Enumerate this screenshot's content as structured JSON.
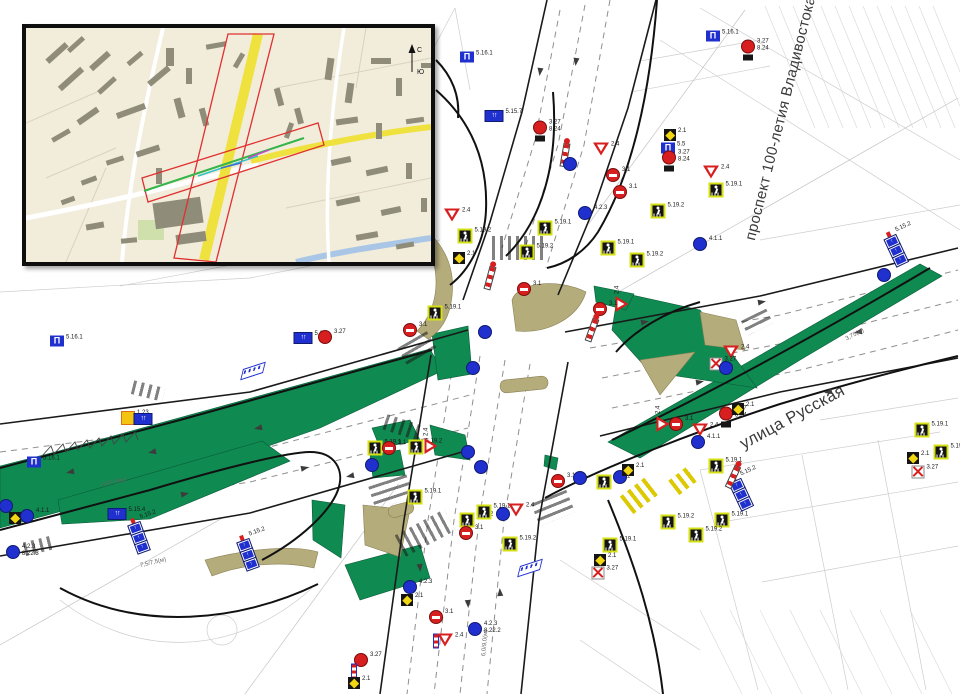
{
  "streets": {
    "prospekt": "проспект 100-летия Владивостока",
    "russkaya": "улица Русская"
  },
  "inset": {
    "compass_north": "С",
    "compass_south": "Ю"
  },
  "colors": {
    "median_green": "#0f8a51",
    "island_tan": "#b5ac7c",
    "sign_blue": "#2030cf",
    "sign_red": "#d81f1f",
    "sign_backing_yellow_green": "#d5e014",
    "priority_yellow": "#f0d613",
    "map_background": "#f2ecdb",
    "corridor_red": "#e03030",
    "map_road_yellow": "#efe23e",
    "map_water_blue": "#a9c6e6"
  },
  "annotations": [
    {
      "text": "7,5/7,5(м)",
      "x": 100,
      "y": 480,
      "r": -14
    },
    {
      "text": "7,5/7,5(м)",
      "x": 140,
      "y": 560,
      "r": -14
    },
    {
      "text": "3,75(м)",
      "x": 845,
      "y": 332,
      "r": -28
    },
    {
      "text": "6,0/9,0(м)",
      "x": 472,
      "y": 640,
      "r": -85
    }
  ],
  "signs": [
    {
      "t": "bus",
      "x": 467,
      "y": 57,
      "l": "5.16.1"
    },
    {
      "t": "ns",
      "x": 540,
      "y": 131,
      "l": "3.27",
      "sub": "8.24"
    },
    {
      "t": "bus",
      "x": 713,
      "y": 36,
      "l": "5.16.1"
    },
    {
      "t": "ns",
      "x": 748,
      "y": 50,
      "l": "3.27",
      "sub": "8.24"
    },
    {
      "t": "brd",
      "x": 494,
      "y": 116,
      "l": "5.15.7"
    },
    {
      "t": "mst",
      "x": 565,
      "y": 155,
      "r": 10
    },
    {
      "t": "gw",
      "x": 601,
      "y": 149,
      "l": "2.4"
    },
    {
      "t": "bc",
      "x": 570,
      "y": 164
    },
    {
      "t": "ne",
      "x": 613,
      "y": 175,
      "l": "3.1"
    },
    {
      "t": "ne",
      "x": 620,
      "y": 192,
      "l": "3.1"
    },
    {
      "t": "bc",
      "x": 585,
      "y": 213,
      "l": "4.2.3"
    },
    {
      "t": "pr",
      "x": 670,
      "y": 135,
      "l": "2.1"
    },
    {
      "t": "bus",
      "x": 668,
      "y": 148,
      "l": "5.5"
    },
    {
      "t": "ns",
      "x": 669,
      "y": 161,
      "l": "3.27",
      "sub": "8.24"
    },
    {
      "t": "gw",
      "x": 711,
      "y": 172,
      "l": "2.4"
    },
    {
      "t": "ped",
      "x": 716,
      "y": 190,
      "l": "5.19.1"
    },
    {
      "t": "ped",
      "x": 658,
      "y": 211,
      "l": "5.19.2"
    },
    {
      "t": "bc",
      "x": 700,
      "y": 244,
      "l": "4.1.1"
    },
    {
      "t": "ped",
      "x": 608,
      "y": 248,
      "l": "5.19.1"
    },
    {
      "t": "ped",
      "x": 637,
      "y": 260,
      "l": "5.19.2"
    },
    {
      "t": "gw",
      "x": 622,
      "y": 304,
      "r": -90,
      "l": "2.4"
    },
    {
      "t": "ne",
      "x": 600,
      "y": 309,
      "l": "3.1"
    },
    {
      "t": "mst",
      "x": 592,
      "y": 330,
      "r": 20
    },
    {
      "t": "ped",
      "x": 545,
      "y": 228,
      "l": "5.19.1"
    },
    {
      "t": "ped",
      "x": 527,
      "y": 252,
      "l": "5.19.2"
    },
    {
      "t": "ne",
      "x": 524,
      "y": 289,
      "l": "3.1"
    },
    {
      "t": "ped",
      "x": 465,
      "y": 236,
      "l": "5.19.2"
    },
    {
      "t": "pr",
      "x": 459,
      "y": 258,
      "l": "2.1"
    },
    {
      "t": "gw",
      "x": 452,
      "y": 215,
      "l": "2.4"
    },
    {
      "t": "mst",
      "x": 490,
      "y": 278,
      "r": 15
    },
    {
      "t": "bc",
      "x": 485,
      "y": 332
    },
    {
      "t": "bc",
      "x": 473,
      "y": 368
    },
    {
      "t": "ped",
      "x": 435,
      "y": 313,
      "l": "5.19.1"
    },
    {
      "t": "ne",
      "x": 410,
      "y": 330,
      "l": "3.1"
    },
    {
      "t": "brd",
      "x": 303,
      "y": 338,
      "l": "5.16"
    },
    {
      "t": "ns",
      "x": 325,
      "y": 337,
      "l": "3.27"
    },
    {
      "t": "bus",
      "x": 57,
      "y": 341,
      "l": "5.16.1"
    },
    {
      "t": "wrn",
      "x": 128,
      "y": 418,
      "l": "1.23"
    },
    {
      "t": "brd",
      "x": 143,
      "y": 419
    },
    {
      "t": "bus",
      "x": 34,
      "y": 462,
      "l": "5.16.1"
    },
    {
      "t": "bc",
      "x": 6,
      "y": 506
    },
    {
      "t": "pr",
      "x": 15,
      "y": 518,
      "l": "2.1"
    },
    {
      "t": "bc",
      "x": 27,
      "y": 516,
      "l": "4.1.1"
    },
    {
      "t": "brd",
      "x": 117,
      "y": 514,
      "l": "5.15.4"
    },
    {
      "t": "bc",
      "x": 13,
      "y": 552,
      "l": "4.2.3",
      "sub": "8.22.3"
    },
    {
      "t": "stk",
      "x": 138,
      "y": 535,
      "r": -20,
      "l": "5.15.2"
    },
    {
      "t": "stk",
      "x": 247,
      "y": 552,
      "r": -20,
      "l": "5.15.2"
    },
    {
      "t": "shl",
      "x": 253,
      "y": 371,
      "r": -18
    },
    {
      "t": "ped",
      "x": 375,
      "y": 448,
      "l": "5.19.1"
    },
    {
      "t": "ne",
      "x": 389,
      "y": 448,
      "l": "3.1"
    },
    {
      "t": "ped",
      "x": 416,
      "y": 447,
      "l": "5.19.2"
    },
    {
      "t": "gw",
      "x": 431,
      "y": 446,
      "r": -90,
      "l": "2.4"
    },
    {
      "t": "bc",
      "x": 372,
      "y": 465
    },
    {
      "t": "bc",
      "x": 468,
      "y": 452
    },
    {
      "t": "bc",
      "x": 481,
      "y": 467
    },
    {
      "t": "ped",
      "x": 415,
      "y": 497,
      "l": "5.19.1"
    },
    {
      "t": "ped",
      "x": 467,
      "y": 520,
      "l": "5.19.2"
    },
    {
      "t": "ne",
      "x": 466,
      "y": 533,
      "l": "3.1"
    },
    {
      "t": "ped",
      "x": 484,
      "y": 512,
      "l": "5.19.1"
    },
    {
      "t": "gw",
      "x": 516,
      "y": 510,
      "l": "2.4"
    },
    {
      "t": "bc",
      "x": 503,
      "y": 514
    },
    {
      "t": "ped",
      "x": 510,
      "y": 544,
      "l": "5.19.2"
    },
    {
      "t": "shl",
      "x": 530,
      "y": 568,
      "r": -18
    },
    {
      "t": "bc",
      "x": 410,
      "y": 587,
      "l": "4.2.3"
    },
    {
      "t": "pr",
      "x": 407,
      "y": 600,
      "l": "2.1"
    },
    {
      "t": "ne",
      "x": 436,
      "y": 617,
      "l": "3.1"
    },
    {
      "t": "flg",
      "x": 436,
      "y": 641
    },
    {
      "t": "gw",
      "x": 445,
      "y": 640,
      "l": "2.4"
    },
    {
      "t": "bc",
      "x": 475,
      "y": 629,
      "l": "4.2.3",
      "sub": "8.22.2"
    },
    {
      "t": "ns",
      "x": 361,
      "y": 660,
      "l": "3.27"
    },
    {
      "t": "flg",
      "x": 354,
      "y": 671
    },
    {
      "t": "pr",
      "x": 354,
      "y": 683,
      "l": "2.1"
    },
    {
      "t": "ne",
      "x": 558,
      "y": 481,
      "l": "3.1"
    },
    {
      "t": "bc",
      "x": 580,
      "y": 478
    },
    {
      "t": "ped",
      "x": 604,
      "y": 482,
      "l": "5.19.1"
    },
    {
      "t": "bc",
      "x": 620,
      "y": 477
    },
    {
      "t": "pr",
      "x": 628,
      "y": 470,
      "l": "2.1"
    },
    {
      "t": "ped",
      "x": 668,
      "y": 522,
      "l": "5.19.2"
    },
    {
      "t": "ped",
      "x": 610,
      "y": 545,
      "l": "5.19.1"
    },
    {
      "t": "pr",
      "x": 600,
      "y": 560,
      "l": "2.1"
    },
    {
      "t": "rx",
      "x": 598,
      "y": 573,
      "l": "3.27"
    },
    {
      "t": "ped",
      "x": 722,
      "y": 520,
      "l": "5.19.1"
    },
    {
      "t": "ped",
      "x": 696,
      "y": 535,
      "l": "5.19.2"
    },
    {
      "t": "stk",
      "x": 740,
      "y": 492,
      "r": -25,
      "l": "5.15.2"
    },
    {
      "t": "gw",
      "x": 663,
      "y": 424,
      "r": -90,
      "l": "2.4"
    },
    {
      "t": "ne",
      "x": 676,
      "y": 424,
      "l": "3.1"
    },
    {
      "t": "gw",
      "x": 700,
      "y": 430,
      "l": "2.4"
    },
    {
      "t": "bc",
      "x": 698,
      "y": 442,
      "l": "4.1.1"
    },
    {
      "t": "ns",
      "x": 726,
      "y": 417,
      "l": "3.27",
      "sub": "8.24"
    },
    {
      "t": "pr",
      "x": 738,
      "y": 409,
      "l": "2.1"
    },
    {
      "t": "ped",
      "x": 716,
      "y": 466,
      "l": "5.19.1"
    },
    {
      "t": "mst",
      "x": 733,
      "y": 477,
      "r": 25
    },
    {
      "t": "gw",
      "x": 731,
      "y": 352,
      "l": "2.4"
    },
    {
      "t": "rx",
      "x": 716,
      "y": 364,
      "l": "3.27"
    },
    {
      "t": "bc",
      "x": 726,
      "y": 368
    },
    {
      "t": "stk",
      "x": 895,
      "y": 248,
      "r": -25,
      "l": "5.15.2"
    },
    {
      "t": "bc",
      "x": 884,
      "y": 275
    },
    {
      "t": "ped",
      "x": 922,
      "y": 430,
      "l": "5.19.1"
    },
    {
      "t": "ped",
      "x": 941,
      "y": 452,
      "l": "5.19.2"
    },
    {
      "t": "pr",
      "x": 913,
      "y": 458,
      "l": "2.1"
    },
    {
      "t": "rx",
      "x": 918,
      "y": 472,
      "l": "3.27"
    }
  ],
  "zebras": [
    {
      "x": 520,
      "y": 248,
      "w": 56,
      "h": 24,
      "r": 0
    },
    {
      "x": 418,
      "y": 350,
      "w": 24,
      "h": 34,
      "r": 60
    },
    {
      "x": 404,
      "y": 428,
      "w": 40,
      "h": 16,
      "r": 18
    },
    {
      "x": 391,
      "y": 492,
      "w": 24,
      "h": 40,
      "r": 72
    },
    {
      "x": 425,
      "y": 533,
      "w": 56,
      "h": 24,
      "r": -28
    },
    {
      "x": 553,
      "y": 508,
      "w": 24,
      "h": 38,
      "r": 68
    },
    {
      "x": 148,
      "y": 391,
      "w": 32,
      "h": 14,
      "r": 14
    },
    {
      "x": 38,
      "y": 546,
      "w": 28,
      "h": 14,
      "r": -14
    },
    {
      "x": 757,
      "y": 322,
      "w": 16,
      "h": 28,
      "r": 64
    },
    {
      "x": 640,
      "y": 495,
      "w": 34,
      "h": 22,
      "r": -38,
      "c": "y"
    },
    {
      "x": 684,
      "y": 480,
      "w": 26,
      "h": 18,
      "r": -38,
      "c": "y"
    }
  ],
  "arrows": [
    {
      "x": 70,
      "y": 472,
      "r": 168
    },
    {
      "x": 152,
      "y": 452,
      "r": 168
    },
    {
      "x": 258,
      "y": 428,
      "r": 168
    },
    {
      "x": 185,
      "y": 494,
      "r": -12
    },
    {
      "x": 305,
      "y": 468,
      "r": -12
    },
    {
      "x": 350,
      "y": 476,
      "r": 168
    },
    {
      "x": 645,
      "y": 322,
      "r": -10
    },
    {
      "x": 762,
      "y": 302,
      "r": -10
    },
    {
      "x": 858,
      "y": 332,
      "r": 170
    },
    {
      "x": 828,
      "y": 392,
      "r": 168
    },
    {
      "x": 700,
      "y": 382,
      "r": -10
    },
    {
      "x": 540,
      "y": 72,
      "r": 97
    },
    {
      "x": 576,
      "y": 62,
      "r": 97
    },
    {
      "x": 468,
      "y": 604,
      "r": 86
    },
    {
      "x": 500,
      "y": 592,
      "r": -94
    },
    {
      "x": 420,
      "y": 568,
      "r": 84
    }
  ]
}
